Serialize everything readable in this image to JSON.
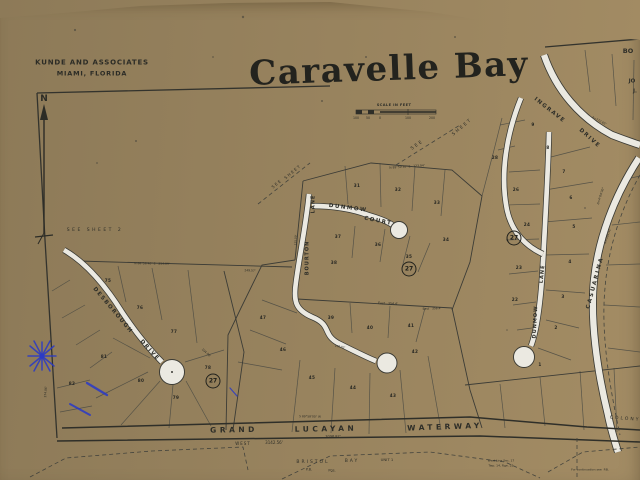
{
  "photo": {
    "backing_color": "#97835f",
    "paper_color": "#ebe9e1",
    "ink_color": "#33332d",
    "pen_color": "#2838c8"
  },
  "header": {
    "firm_line1": "KUNDE AND ASSOCIATES",
    "firm_line2": "MIAMI, FLORIDA",
    "title": "Caravelle Bay",
    "edge_cutoff_texts": [
      "BO",
      "JO",
      "J."
    ]
  },
  "north_arrow": {
    "label": "N"
  },
  "scale_bar": {
    "caption": "SCALE IN FEET",
    "ticks": [
      "100",
      "50",
      "0",
      "100",
      "200"
    ],
    "tick_x": [
      4,
      16,
      28,
      56,
      80
    ]
  },
  "waterway_label": [
    "GRAND",
    "LUCAYAN",
    "WATERWAY"
  ],
  "streets": [
    "DESBOROUGH DRIVE",
    "BOURTON LANE",
    "DUNMOW COURT",
    "DUNMOW LANE",
    "INGRAVE DRIVE",
    "CASUARINA DRIVE"
  ],
  "badges": [
    {
      "label": "27",
      "x": 213,
      "y": 381
    },
    {
      "label": "27",
      "x": 409,
      "y": 269
    },
    {
      "label": "27",
      "x": 514,
      "y": 238
    }
  ],
  "lots": [
    {
      "n": "75",
      "x": 108,
      "y": 281
    },
    {
      "n": "76",
      "x": 140,
      "y": 308
    },
    {
      "n": "77",
      "x": 174,
      "y": 332
    },
    {
      "n": "78",
      "x": 208,
      "y": 368
    },
    {
      "n": "79",
      "x": 176,
      "y": 398
    },
    {
      "n": "80",
      "x": 141,
      "y": 381
    },
    {
      "n": "81",
      "x": 104,
      "y": 357
    },
    {
      "n": "82",
      "x": 72,
      "y": 384
    },
    {
      "n": "31",
      "x": 357,
      "y": 186
    },
    {
      "n": "32",
      "x": 398,
      "y": 190
    },
    {
      "n": "33",
      "x": 437,
      "y": 203
    },
    {
      "n": "34",
      "x": 446,
      "y": 240
    },
    {
      "n": "35",
      "x": 409,
      "y": 257
    },
    {
      "n": "36",
      "x": 378,
      "y": 245
    },
    {
      "n": "37",
      "x": 338,
      "y": 237
    },
    {
      "n": "38",
      "x": 334,
      "y": 263
    },
    {
      "n": "39",
      "x": 331,
      "y": 318
    },
    {
      "n": "40",
      "x": 370,
      "y": 328
    },
    {
      "n": "41",
      "x": 411,
      "y": 326
    },
    {
      "n": "42",
      "x": 415,
      "y": 352
    },
    {
      "n": "43",
      "x": 393,
      "y": 396
    },
    {
      "n": "44",
      "x": 353,
      "y": 388
    },
    {
      "n": "45",
      "x": 312,
      "y": 378
    },
    {
      "n": "46",
      "x": 283,
      "y": 350
    },
    {
      "n": "47",
      "x": 263,
      "y": 318
    },
    {
      "n": "28",
      "x": 495,
      "y": 158
    },
    {
      "n": "26",
      "x": 516,
      "y": 190
    },
    {
      "n": "24",
      "x": 527,
      "y": 225
    },
    {
      "n": "23",
      "x": 519,
      "y": 268
    },
    {
      "n": "22",
      "x": 515,
      "y": 300
    },
    {
      "n": "9",
      "x": 533,
      "y": 125
    },
    {
      "n": "8",
      "x": 548,
      "y": 148
    },
    {
      "n": "7",
      "x": 564,
      "y": 172
    },
    {
      "n": "6",
      "x": 571,
      "y": 198
    },
    {
      "n": "5",
      "x": 574,
      "y": 227
    },
    {
      "n": "4",
      "x": 570,
      "y": 262
    },
    {
      "n": "3",
      "x": 563,
      "y": 297
    },
    {
      "n": "2",
      "x": 556,
      "y": 328
    },
    {
      "n": "1",
      "x": 540,
      "y": 365
    }
  ],
  "map_texts": [
    {
      "t": "SEE SHEET 2",
      "x": 95,
      "y": 231,
      "fs": 4.5,
      "ls": 2.5
    },
    {
      "t": "DESBOROUGH",
      "x": 112,
      "y": 311,
      "r": 50,
      "fs": 5.5,
      "ls": 1.5,
      "b": 1
    },
    {
      "t": "DRIVE",
      "x": 149,
      "y": 351,
      "r": 48,
      "fs": 5.5,
      "ls": 1.5,
      "b": 1
    },
    {
      "t": "BOURTON",
      "x": 308,
      "y": 258,
      "r": -90,
      "fs": 5,
      "ls": 1,
      "b": 1
    },
    {
      "t": "LANE",
      "x": 314,
      "y": 204,
      "r": -90,
      "fs": 5,
      "ls": 1,
      "b": 1
    },
    {
      "t": "DUNMOW",
      "x": 348,
      "y": 209,
      "r": 7,
      "fs": 5.5,
      "ls": 1.5,
      "b": 1
    },
    {
      "t": "COURT",
      "x": 378,
      "y": 222,
      "r": 11,
      "fs": 5.5,
      "ls": 1.5,
      "b": 1
    },
    {
      "t": "DUNMOW",
      "x": 536,
      "y": 322,
      "r": -87,
      "fs": 5,
      "ls": 1,
      "b": 1
    },
    {
      "t": "LANE",
      "x": 543,
      "y": 274,
      "r": -84,
      "fs": 5,
      "ls": 1,
      "b": 1
    },
    {
      "t": "INGRAVE",
      "x": 549,
      "y": 111,
      "r": 38,
      "fs": 5.5,
      "ls": 1.5,
      "b": 1
    },
    {
      "t": "DRIVE",
      "x": 589,
      "y": 139,
      "r": 42,
      "fs": 5.5,
      "ls": 1.5,
      "b": 1
    },
    {
      "t": "CASUARINA",
      "x": 596,
      "y": 283,
      "r": -75,
      "fs": 5.5,
      "ls": 2,
      "b": 1
    },
    {
      "t": "GRAND",
      "x": 234,
      "y": 430,
      "r": -1,
      "fs": 7.5,
      "ls": 3.5,
      "b": 1
    },
    {
      "t": "LUCAYAN",
      "x": 326,
      "y": 429,
      "r": -1,
      "fs": 7.5,
      "ls": 3.5,
      "b": 1
    },
    {
      "t": "WATERWAY",
      "x": 445,
      "y": 427,
      "r": -2,
      "fs": 7.5,
      "ls": 3.5,
      "b": 1
    },
    {
      "t": "WEST",
      "x": 243,
      "y": 444,
      "fs": 4,
      "ls": 1
    },
    {
      "t": "3142.56'",
      "x": 274,
      "y": 443,
      "fs": 4
    },
    {
      "t": "3096.87'",
      "x": 333,
      "y": 437,
      "fs": 3.5
    },
    {
      "t": "BRISTOL",
      "x": 313,
      "y": 463,
      "fs": 4.5,
      "ls": 2
    },
    {
      "t": "BAY",
      "x": 352,
      "y": 462,
      "fs": 4.5,
      "ls": 2
    },
    {
      "t": "UNIT 1",
      "x": 387,
      "y": 460,
      "fs": 3.8
    },
    {
      "t": "P.B.",
      "x": 309,
      "y": 470,
      "fs": 3.5
    },
    {
      "t": "Pgs.",
      "x": 332,
      "y": 471,
      "fs": 3.5
    },
    {
      "t": "COLONY",
      "x": 625,
      "y": 420,
      "r": 4,
      "fs": 4.5,
      "ls": 2
    },
    {
      "t": "BO",
      "x": 628,
      "y": 51,
      "fs": 6.5,
      "b": 1
    },
    {
      "t": "JO",
      "x": 632,
      "y": 82,
      "fs": 5.5,
      "b": 1
    },
    {
      "t": "J.",
      "x": 635,
      "y": 92,
      "fs": 5,
      "b": 1
    },
    {
      "t": "SEE",
      "x": 418,
      "y": 146,
      "r": -35,
      "fs": 4.5,
      "ls": 2
    },
    {
      "t": "SHEET",
      "x": 463,
      "y": 128,
      "r": -40,
      "fs": 4.5,
      "ls": 2
    },
    {
      "t": "SEE",
      "x": 277,
      "y": 184,
      "r": -40,
      "fs": 4,
      "ls": 1.5
    },
    {
      "t": "SHEET",
      "x": 293,
      "y": 172,
      "r": -40,
      "fs": 4,
      "ls": 1.5
    },
    {
      "t": "N 88°36'40\" E   254.09'",
      "x": 152,
      "y": 264,
      "r": 1,
      "fs": 3
    },
    {
      "t": "249.57'",
      "x": 250,
      "y": 271,
      "r": 2,
      "fs": 3
    },
    {
      "t": "N 89°59'30\" E   123.94'",
      "x": 407,
      "y": 167,
      "r": -4,
      "fs": 3
    },
    {
      "t": "East   354.4'",
      "x": 388,
      "y": 304,
      "r": 2,
      "fs": 3.2
    },
    {
      "t": "East   356.4'",
      "x": 432,
      "y": 309,
      "r": -2,
      "fs": 3
    },
    {
      "t": "S 89°58'00\" W",
      "x": 310,
      "y": 417,
      "r": 1,
      "fs": 3
    },
    {
      "t": "104.06'",
      "x": 206,
      "y": 353,
      "r": 42,
      "fs": 3
    },
    {
      "t": "A=772.65'",
      "x": 599,
      "y": 121,
      "r": 28,
      "fs": 3
    },
    {
      "t": "Δ=4°04'30\"",
      "x": 601,
      "y": 196,
      "r": -72,
      "fs": 3
    },
    {
      "t": "A=503.42'",
      "x": 608,
      "y": 236,
      "r": -72,
      "fs": 3
    },
    {
      "t": "374.86'",
      "x": 46,
      "y": 392,
      "r": -86,
      "fs": 3
    },
    {
      "t": "West Line Sec. 17",
      "x": 501,
      "y": 461,
      "fs": 3
    },
    {
      "t": "Twp. 14, Rge. 25",
      "x": 501,
      "y": 466,
      "fs": 3
    },
    {
      "t": "For continuation see  P.B.",
      "x": 590,
      "y": 470,
      "fs": 3
    },
    {
      "t": "130.02'",
      "x": 340,
      "y": 347,
      "r": 12,
      "fs": 2.8
    },
    {
      "t": "125.00'",
      "x": 296,
      "y": 240,
      "r": -88,
      "fs": 2.8
    }
  ]
}
